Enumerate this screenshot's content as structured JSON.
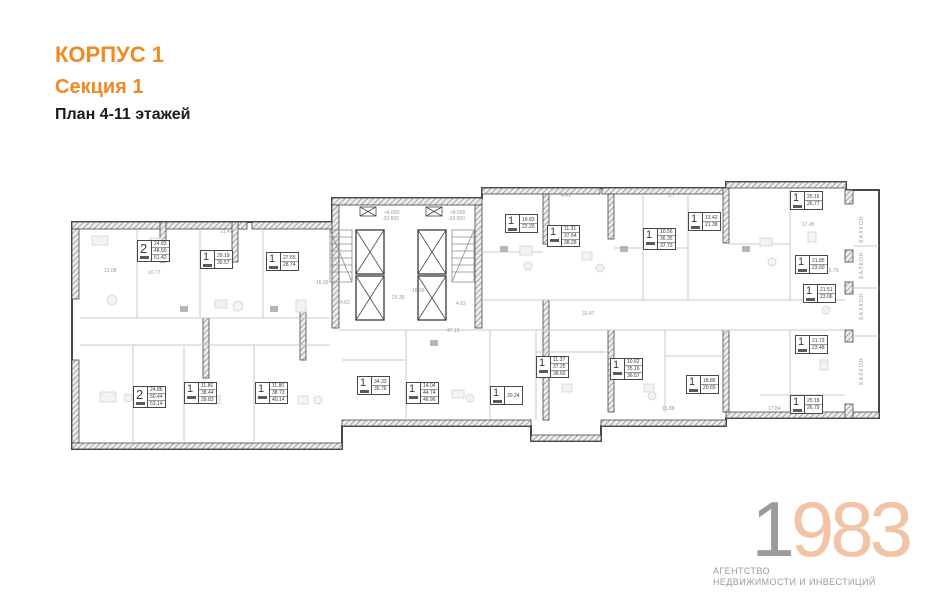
{
  "header": {
    "korpus": "КОРПУС 1",
    "sektsiya": "Секция 1",
    "plan_title": "План 4-11 этажей"
  },
  "logo": {
    "year_digit1": "1",
    "year_rest": "983",
    "sub1": "АГЕНТСТВО",
    "sub2": "НЕДВИЖИМОСТИ И ИНВЕСТИЦИЙ"
  },
  "colors": {
    "accent_orange": "#EF8B22",
    "logo_gray": "#9B9B9B",
    "logo_peach": "#F2C3A4",
    "plan_dark": "#474747",
    "plan_light": "#c9c9c9"
  },
  "plan": {
    "balcony_label": "БАЛКОН",
    "balconies": [
      {
        "x": 841,
        "y": 226
      },
      {
        "x": 841,
        "y": 262
      },
      {
        "x": 841,
        "y": 303
      },
      {
        "x": 841,
        "y": 368
      }
    ],
    "units": [
      {
        "type": "2",
        "areas": [
          "24.83",
          "48.50",
          "51.42"
        ],
        "x": 137,
        "y": 240
      },
      {
        "type": "1",
        "areas": [
          "29.19",
          "30.57"
        ],
        "x": 200,
        "y": 250
      },
      {
        "type": "1",
        "areas": [
          "27.55",
          "28.74"
        ],
        "x": 266,
        "y": 252
      },
      {
        "type": "1",
        "areas": [
          "19.83",
          "22.20"
        ],
        "x": 505,
        "y": 214
      },
      {
        "type": "1",
        "areas": [
          "11.31",
          "37.64",
          "38.28"
        ],
        "x": 547,
        "y": 225
      },
      {
        "type": "1",
        "areas": [
          "10.56",
          "36.35",
          "37.73"
        ],
        "x": 643,
        "y": 228
      },
      {
        "type": "1",
        "areas": [
          "13.42",
          "21.38"
        ],
        "x": 688,
        "y": 212
      },
      {
        "type": "1",
        "areas": [
          "25.16",
          "26.77"
        ],
        "x": 790,
        "y": 191
      },
      {
        "type": "1",
        "areas": [
          "21.85",
          "23.60"
        ],
        "x": 795,
        "y": 255
      },
      {
        "type": "1",
        "areas": [
          "21.51",
          "23.06"
        ],
        "x": 803,
        "y": 284
      },
      {
        "type": "1",
        "areas": [
          "21.73",
          "23.48"
        ],
        "x": 795,
        "y": 335
      },
      {
        "type": "1",
        "areas": [
          "25.18",
          "26.79"
        ],
        "x": 790,
        "y": 395
      },
      {
        "type": "1",
        "areas": [
          "18.85",
          "20.65"
        ],
        "x": 686,
        "y": 375
      },
      {
        "type": "1",
        "areas": [
          "10.62",
          "35.16",
          "36.57"
        ],
        "x": 610,
        "y": 358
      },
      {
        "type": "1",
        "areas": [
          "11.37",
          "37.25",
          "38.60"
        ],
        "x": 536,
        "y": 356
      },
      {
        "type": "1",
        "areas": [
          "20.24"
        ],
        "x": 490,
        "y": 386
      },
      {
        "type": "1",
        "areas": [
          "14.04",
          "44.74",
          "46.96"
        ],
        "x": 406,
        "y": 382
      },
      {
        "type": "1",
        "areas": [
          "34.33",
          "35.76"
        ],
        "x": 357,
        "y": 376
      },
      {
        "type": "1",
        "areas": [
          "11.80",
          "38.73",
          "40.14"
        ],
        "x": 255,
        "y": 382
      },
      {
        "type": "1",
        "areas": [
          "11.86",
          "38.44",
          "39.83"
        ],
        "x": 184,
        "y": 382
      },
      {
        "type": "2",
        "areas": [
          "24.86",
          "50.44",
          "53.14"
        ],
        "x": 133,
        "y": 386
      }
    ],
    "dimensions": [
      {
        "t": "21.47",
        "x": 220,
        "y": 229
      },
      {
        "t": "12.08",
        "x": 104,
        "y": 268
      },
      {
        "t": "10.77",
        "x": 148,
        "y": 270
      },
      {
        "t": "16.66",
        "x": 316,
        "y": 280
      },
      {
        "t": "16.66",
        "x": 412,
        "y": 288
      },
      {
        "t": "25.35",
        "x": 392,
        "y": 295
      },
      {
        "t": "4.62",
        "x": 340,
        "y": 300
      },
      {
        "t": "4.62",
        "x": 456,
        "y": 301
      },
      {
        "t": "47.19",
        "x": 447,
        "y": 328
      },
      {
        "t": "33.47",
        "x": 582,
        "y": 311
      },
      {
        "t": "17.45",
        "x": 802,
        "y": 222
      },
      {
        "t": "16.79",
        "x": 826,
        "y": 268
      },
      {
        "t": "15.88",
        "x": 662,
        "y": 406
      },
      {
        "t": "17.84",
        "x": 768,
        "y": 406
      },
      {
        "t": "4.41",
        "x": 561,
        "y": 193
      },
      {
        "t": "3.7",
        "x": 668,
        "y": 193
      },
      {
        "t": "+8.650",
        "x": 384,
        "y": 210
      },
      {
        "t": "-33.600",
        "x": 382,
        "y": 216
      },
      {
        "t": "+8.650",
        "x": 450,
        "y": 210
      },
      {
        "t": "-33.600",
        "x": 448,
        "y": 216
      }
    ]
  }
}
